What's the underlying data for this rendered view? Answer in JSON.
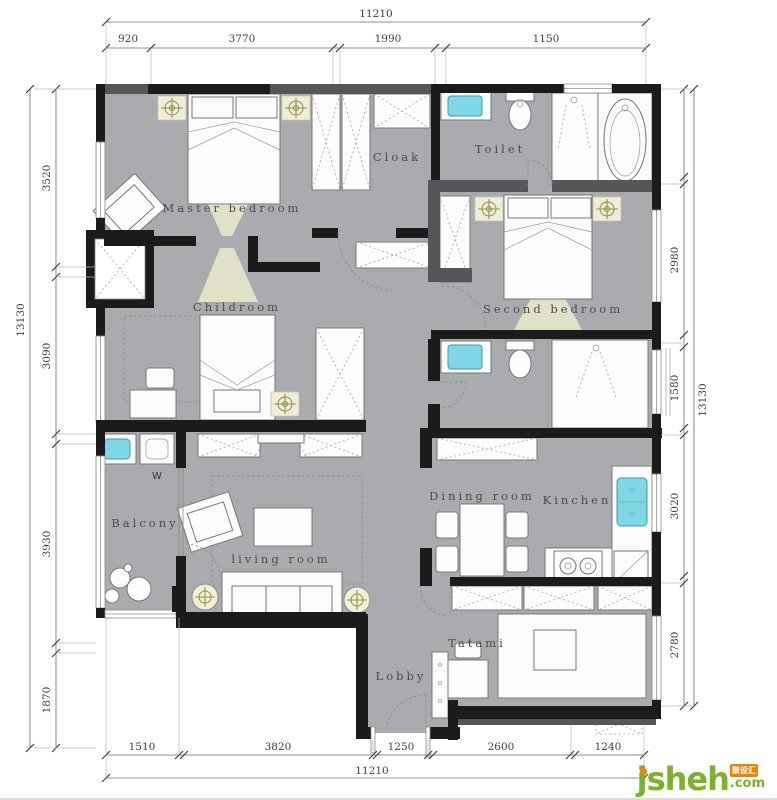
{
  "colors": {
    "wall": "#1b1b1b",
    "wallSoft": "#55555a",
    "floor": "#aaabae",
    "cyan": "#7ed7e6",
    "cyanStroke": "#3d9ab1",
    "beige": "#f0edda",
    "olive": "#8e8e3c",
    "cone": "#e7e7c9",
    "dim": "#3d3d3d",
    "label": "#4a4a4a",
    "green": "#7ab229",
    "orange": "#f08300"
  },
  "plan": {
    "rooms": [
      {
        "id": "master-bedroom",
        "label": "Master bedroom"
      },
      {
        "id": "cloak",
        "label": "Cloak"
      },
      {
        "id": "toilet",
        "label": "Toilet"
      },
      {
        "id": "second-bedroom",
        "label": "Second bedroom"
      },
      {
        "id": "childroom",
        "label": "Childroom"
      },
      {
        "id": "dining-room",
        "label": "Dining room"
      },
      {
        "id": "kitchen",
        "label": "Kinchen"
      },
      {
        "id": "balcony",
        "label": "Balcony"
      },
      {
        "id": "living-room",
        "label": "living room"
      },
      {
        "id": "tatami",
        "label": "Tatami"
      },
      {
        "id": "lobby",
        "label": "Lobby"
      }
    ],
    "washer_label": "W"
  },
  "dimensions": {
    "top": {
      "total": "11210",
      "segments": [
        "920",
        "3770",
        "1990",
        "1150"
      ]
    },
    "bottom": {
      "total": "11210",
      "segments": [
        "1510",
        "3820",
        "1250",
        "2600",
        "1240"
      ]
    },
    "left": {
      "total": "13130",
      "segments": [
        "3520",
        "3090",
        "3930",
        "1870"
      ]
    },
    "right": {
      "total": "13130",
      "segments": [
        "2980",
        "1580",
        "3020",
        "2780"
      ]
    }
  },
  "watermark": {
    "brand": "jsheh",
    "tld": ".com",
    "badge": "聚设汇"
  }
}
